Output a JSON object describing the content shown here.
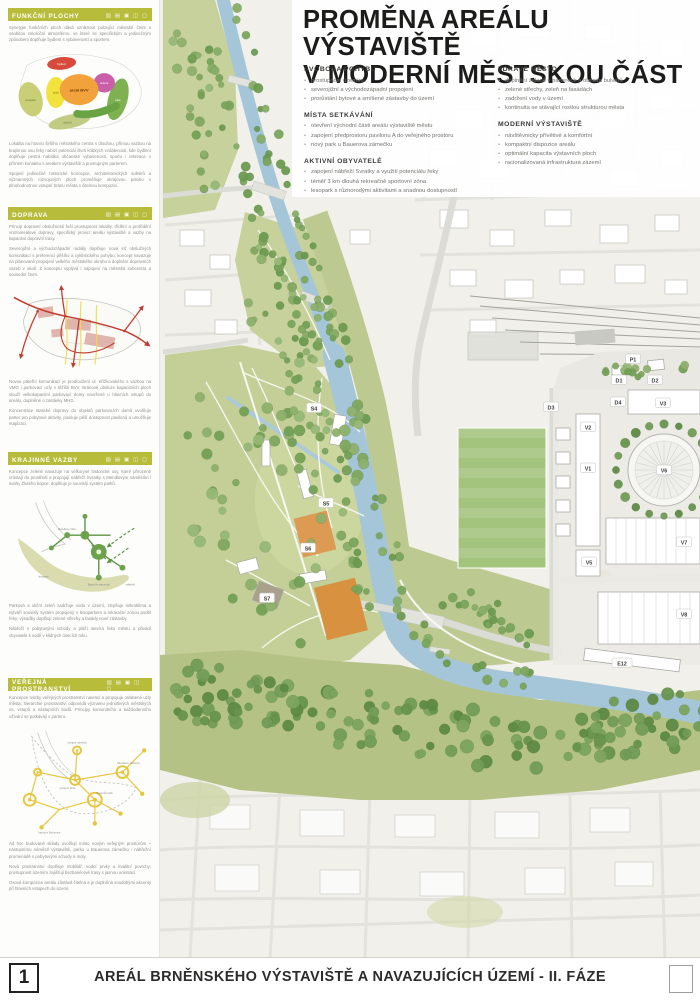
{
  "poster": {
    "title_line1": "PROMĚNA AREÁLU VÝSTAVIŠTĚ",
    "title_line2": "V MODERNÍ MĚSTSKOU ČÁST"
  },
  "principles": {
    "col1": [
      {
        "heading": "SVOBODA POHYBU",
        "items": [
          "prostupnost územím",
          "severojižní a východozápadní propojení",
          "prorůstání bytové a smíšené zástavby do území"
        ]
      },
      {
        "heading": "MÍSTA SETKÁVÁNÍ",
        "items": [
          "otevření východní části areálu výstaviště městu",
          "zapojení předprostoru pavilonu A do veřejného prostoru",
          "nový park u Bauerova zámečku"
        ]
      },
      {
        "heading": "AKTIVNÍ OBYVATELÉ",
        "items": [
          "zapojení nábřeží Svratky a využití potenciálu řeky",
          "téměř 3 km dlouhá rekreačně sportovní zóna",
          "lesopark s různorodými aktivitami a snadnou dostupností"
        ]
      }
    ],
    "col2": [
      {
        "heading": "ZDRAVÉ MĚSTO",
        "items": [
          "doplnění zeleně v parterech a obnova bulvárů",
          "zelené střechy, zeleň na fasádách",
          "zadržení vody v území",
          "kontinuita se stávající rostlou strukturou města"
        ]
      },
      {
        "heading": "MODERNÍ VÝSTAVIŠTĚ",
        "items": [
          "návštěvnicky přívětivé a komfortní",
          "kompaktní dispozice areálu",
          "optimální kapacita výstavních ploch",
          "racionalizovaná infrastruktura zázemí"
        ]
      }
    ]
  },
  "sidebar": {
    "sections": [
      {
        "title": "FUNKČNÍ PLOCHY",
        "icons": "▧ ▤ ▣ ◫ ◻",
        "intro": [
          "Synergie funkčních ploch dává vzniknout pulzující městské čtvrti s osobitou celoroční atmosférou, ve které se specifickým a jedinečným způsobem doplňuje bydlení s vybaveností a sportem."
        ],
        "outro": [
          "Lokalita na hranici širšího městského centra s dlouhou, přímou vazbou na krajinnou osu řeky nabízí potenciál čtvrti krátkých vzdáleností, kde bydlení doplňuje pestrá nabídka občanské vybavenosti, sportu i rekreace v přímém kontaktu s areálem výstaviště a prostupným parterem.",
          "Spojení jedinečné historické koncepce, architektonických solitérů a významných rozvojových ploch proměňuje okrajovou polohu v plnohodnotnou vstupní bránu města s čitelnou kompozicí."
        ],
        "diagram": {
          "center": "areál BVV",
          "labels": [
            "bydlení",
            "sport",
            "kultura",
            "park",
            "lesopark",
            "nábřeží"
          ]
        }
      },
      {
        "title": "DOPRAVA",
        "icons": "▧ ▤ ▣ ◫ ◻",
        "intro": [
          "Princip dopravní obslužnosti řeší prostupnost lokality, třídění a protřídění vnitroareálové dopravy, specifický provoz areálu výstaviště a vazby na kapacitní dopravní trasy.",
          "Severojižní a východozápadní radiály doplňuje nová síť obslužných komunikací s preferencí pěšího a cyklistického pohybu; koncept navazuje na plánované propojení velkého městského okruhu a doplnění dopravních vazeb v okolí. Z konceptu vyplývá i napojení na městská subcentra a sousední čtvrti."
        ],
        "outro": [
          "Novou páteřní komunikací je prodloužení ul. Křížkovského s vazbou na VMO i parkovací uzly v těžišti BVV. Bránové obsluze kapacitních ploch slouží velkokapacitní parkovací domy navržené u hlavních vstupů do areálu, doplněné o zastávky MHD.",
          "Koncentrace statické dopravy do objektů parkovacích domů uvolňuje parter pro pobytové aktivity, posiluje pěší dostupnost pavilonů a umožňuje etapizaci."
        ]
      },
      {
        "title": "KRAJINNÉ VAZBY",
        "icons": "▧ ▤ ▣ ◫ ◻",
        "intro": [
          "Koncepce zeleně navazuje na velkorysé historické osy, které přirozeně vrůstají do prostředí a propojují nábřeží Svratky s Mendlovým náměstím i svahy Žlutého kopce; doplňuje je souvislý systém parků."
        ],
        "outro": [
          "Parková a uliční zeleň zadržuje vodu v území, zlepšuje mikroklima a vytváří souvislý systém propojený s lesoparkem a rekreační zónou podél řeky; výsadby doplňují zelené střechy a fasády nové zástavby.",
          "Nábřeží s pobytovými schody a pláží otevírá řeku městu a přivádí obyvatele k vodě v klidných úsecích toku."
        ],
        "diagram": {
          "labels": [
            "Mendlovo nám.",
            "Bauerův zámeček",
            "lesopark",
            "nábřeží"
          ]
        }
      },
      {
        "title": "VEŘEJNÁ PROSTRANSTVÍ",
        "icons": "▧ ▤ ▣ ◫ ◻",
        "intro": [
          "Koncepce tvorby veřejných prostranství navrací a propojuje oslabené uzly města; hierarchie prostranství odpovídá významu jednotlivých městských os, vstupů a nástupních bodů. Principy komunitního a každodenního užívání se potkávají v parteru."
        ],
        "outro": [
          "Ad hoc budované sklady uvolňují místo novým veřejným prostorům – nástupnímu náměstí výstaviště, parku u Bauerova zámečku i nábřežní promenádě s pobytovými schody a moly.",
          "Nová prostranství doplňuje mobiliář, vodní prvky a kvalitní povrchy; prostupnost územím zajišťují bezbariérové trasy s jasnou orientací.",
          "Osová kompozice areálu zůstává čitelná a je doplněna soudobými akcenty při hlavních vstupech do území."
        ],
        "diagram": {
          "labels": [
            "vstupní náměstí",
            "Mendlovo náměstí",
            "výstavní třída",
            "Bauerův park",
            "kampus Bohunice"
          ]
        }
      }
    ]
  },
  "map": {
    "labels": [
      {
        "code": "P1",
        "x": 633,
        "y": 359
      },
      {
        "code": "D1",
        "x": 619,
        "y": 380
      },
      {
        "code": "D2",
        "x": 655,
        "y": 380
      },
      {
        "code": "D3",
        "x": 551,
        "y": 407
      },
      {
        "code": "D4",
        "x": 618,
        "y": 402
      },
      {
        "code": "V3",
        "x": 663,
        "y": 403
      },
      {
        "code": "V2",
        "x": 588,
        "y": 427
      },
      {
        "code": "V1",
        "x": 588,
        "y": 468
      },
      {
        "code": "V5",
        "x": 589,
        "y": 562
      },
      {
        "code": "V6",
        "x": 664,
        "y": 470
      },
      {
        "code": "V7",
        "x": 684,
        "y": 542
      },
      {
        "code": "V8",
        "x": 684,
        "y": 614
      },
      {
        "code": "E12",
        "x": 622,
        "y": 663
      },
      {
        "code": "S4",
        "x": 314,
        "y": 408
      },
      {
        "code": "S5",
        "x": 326,
        "y": 503
      },
      {
        "code": "S6",
        "x": 308,
        "y": 548
      },
      {
        "code": "S7",
        "x": 267,
        "y": 598
      }
    ]
  },
  "footer": {
    "number": "1",
    "title": "AREÁL BRNĚNSKÉHO VÝSTAVIŠTĚ A NAVAZUJÍCÍCH ÚZEMÍ - II. FÁZE"
  },
  "colors": {
    "accent": "#b7bd3b",
    "river": "#a5c6d8",
    "park": "#c6d19c",
    "forest": "#b5c285",
    "court_orange": "#d8913f",
    "diagram_red": "#c23b2e",
    "diagram_yellow": "#e7c63f",
    "diagram_green": "#5d9444"
  }
}
